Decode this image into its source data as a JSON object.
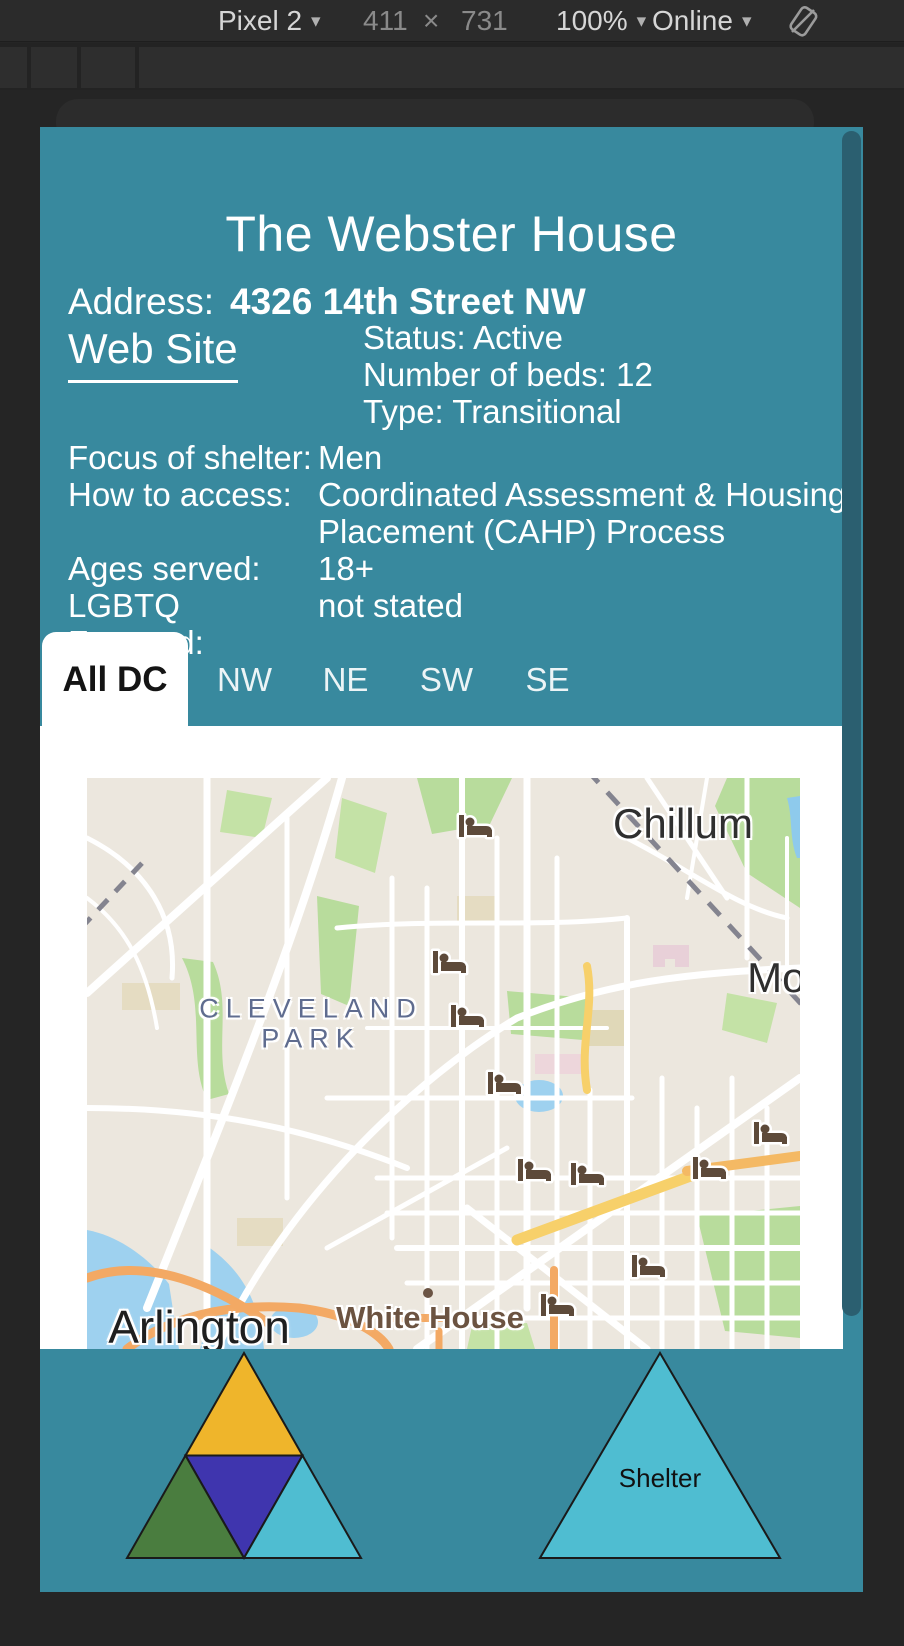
{
  "toolbar": {
    "device": "Pixel 2",
    "viewport_width": "411",
    "times": "×",
    "viewport_height": "731",
    "zoom": "100%",
    "network": "Online",
    "caret": "▾"
  },
  "page": {
    "title": "The Webster House",
    "address_label": "Address:",
    "address_value": "4326 14th Street NW",
    "website_label": "Web Site",
    "status_lines": [
      "Status: Active",
      "Number of beds: 12",
      "Type: Transitional"
    ],
    "details": [
      {
        "label": "Focus of shelter:",
        "value": "Men"
      },
      {
        "label": "How to access:",
        "value": "Coordinated Assessment & Housing Placement (CAHP) Process"
      },
      {
        "label": "Ages served:",
        "value": "18+"
      },
      {
        "label": "LGBTQ Focused:",
        "value": "not stated"
      }
    ],
    "tabs": [
      {
        "label": "All DC",
        "active": true
      },
      {
        "label": "NW",
        "active": false
      },
      {
        "label": "NE",
        "active": false
      },
      {
        "label": "SW",
        "active": false
      },
      {
        "label": "SE",
        "active": false
      }
    ],
    "map": {
      "labels": [
        {
          "text": "Chillum",
          "x": 596,
          "y": 46,
          "cls": "city"
        },
        {
          "text": "CLEVELAND",
          "x": 224,
          "y": 231,
          "cls": "district"
        },
        {
          "text": "PARK",
          "x": 224,
          "y": 261,
          "cls": "district"
        },
        {
          "text": "Mou",
          "x": 701,
          "y": 200,
          "cls": "city"
        },
        {
          "text": "White House",
          "x": 343,
          "y": 540,
          "cls": "poi"
        },
        {
          "text": "Arlington",
          "x": 112,
          "y": 549,
          "cls": "bigcity"
        }
      ],
      "marker_icon": "bed-icon",
      "markers": [
        {
          "x": 389,
          "y": 48
        },
        {
          "x": 363,
          "y": 184
        },
        {
          "x": 381,
          "y": 238
        },
        {
          "x": 418,
          "y": 305
        },
        {
          "x": 684,
          "y": 355
        },
        {
          "x": 448,
          "y": 392
        },
        {
          "x": 501,
          "y": 396
        },
        {
          "x": 623,
          "y": 390
        },
        {
          "x": 562,
          "y": 488
        },
        {
          "x": 471,
          "y": 527
        }
      ]
    },
    "footer": {
      "logo_left": {
        "top_color": "#EFB52B",
        "center_color": "#3F35AE",
        "left_color": "#4A7D3F",
        "right_color": "#4FBDD1"
      },
      "logo_right": {
        "fill": "#4FBDD1",
        "label": "Shelter"
      }
    }
  },
  "colors": {
    "page_teal": "#38899E",
    "scrollbar_thumb": "#2B5F70",
    "marker_brown": "#5D4A3A",
    "frame_dark": "#252525"
  }
}
